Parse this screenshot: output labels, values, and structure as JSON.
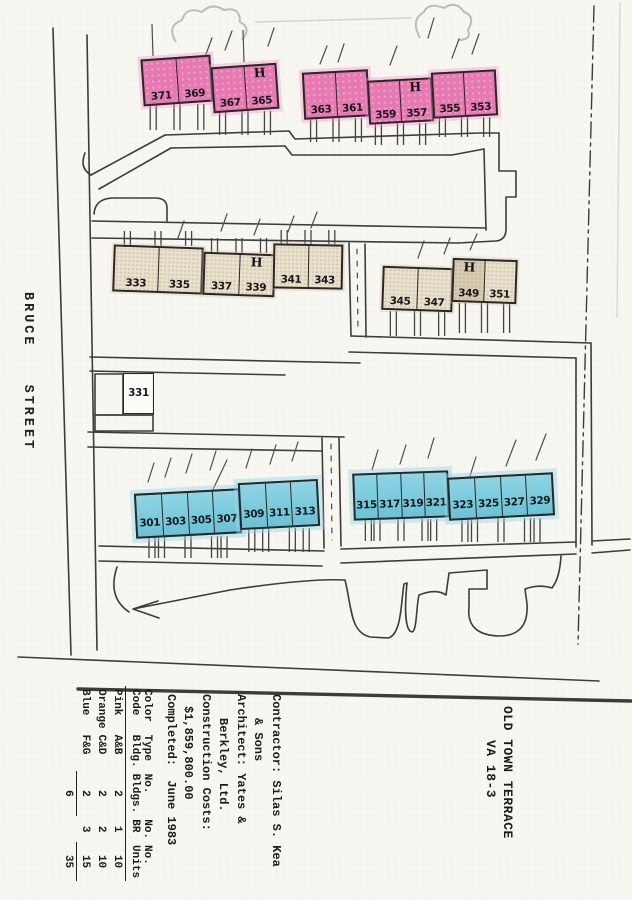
{
  "street_label": "BRUCE STREET",
  "title_block": {
    "project_title_line1": "OLD TOWN TERRACE",
    "project_title_line2": "VA 18-3",
    "info_lines": [
      "Contractor: Silas S. Kea",
      "& Sons",
      "Architect: Yates &",
      "Berkley, Ltd.",
      "Construction Costs:",
      "$1,859,800.00",
      "Completed:  June 1983"
    ]
  },
  "legend_table": {
    "headers": [
      "Color Code",
      "Type Bldg.",
      "No. Bldgs.",
      "No. BR",
      "No. Units"
    ],
    "rows": [
      [
        "Pink",
        "A&B",
        "2",
        "1",
        "10"
      ],
      [
        "Orange",
        "C&D",
        "2",
        "2",
        "10"
      ],
      [
        "Blue",
        "F&G",
        "2",
        "3",
        "15"
      ]
    ],
    "totals": {
      "bldgs": "6",
      "units": "35"
    }
  },
  "colors": {
    "pink": "#e678b2",
    "orange_tan": "#e9e1cd",
    "blue": "#72cade"
  },
  "map": {
    "handicap_marker": "H",
    "buildings": [
      {
        "x": 142,
        "y": 57,
        "w": 70,
        "h": 47,
        "rot": -4,
        "color": "pink",
        "units": [
          {
            "n": "371"
          },
          {
            "n": "369"
          }
        ],
        "stub": {
          "dir": "down",
          "len": 26
        }
      },
      {
        "x": 212,
        "y": 65,
        "w": 66,
        "h": 46,
        "rot": -4,
        "color": "pink",
        "units": [
          {
            "n": "367"
          },
          {
            "n": "365",
            "h": true
          }
        ],
        "stub": {
          "dir": "down",
          "len": 24
        }
      },
      {
        "x": 303,
        "y": 71,
        "w": 66,
        "h": 47,
        "rot": -3,
        "color": "pink",
        "units": [
          {
            "n": "363"
          },
          {
            "n": "361"
          }
        ],
        "stub": {
          "dir": "down",
          "len": 24
        }
      },
      {
        "x": 368,
        "y": 79,
        "w": 65,
        "h": 44,
        "rot": -3,
        "color": "pink",
        "units": [
          {
            "n": "359"
          },
          {
            "n": "357",
            "h": true
          }
        ],
        "stub": {
          "dir": "down",
          "len": 22
        }
      },
      {
        "x": 432,
        "y": 71,
        "w": 65,
        "h": 46,
        "rot": -3,
        "color": "pink",
        "units": [
          {
            "n": "355"
          },
          {
            "n": "353"
          }
        ],
        "stub": {
          "dir": "down",
          "len": 20
        }
      },
      {
        "x": 113,
        "y": 246,
        "w": 90,
        "h": 47,
        "rot": 2,
        "color": "tan",
        "units": [
          {
            "n": "333"
          },
          {
            "n": "335"
          }
        ],
        "stub": {
          "dir": "up",
          "len": 15
        }
      },
      {
        "x": 203,
        "y": 253,
        "w": 72,
        "h": 43,
        "rot": 2,
        "color": "tan",
        "units": [
          {
            "n": "337"
          },
          {
            "n": "339",
            "h": true
          }
        ],
        "stub": {
          "dir": "up",
          "len": 15
        }
      },
      {
        "x": 273,
        "y": 244,
        "w": 70,
        "h": 45,
        "rot": 1,
        "color": "tan",
        "units": [
          {
            "n": "341"
          },
          {
            "n": "343"
          }
        ],
        "stub": {
          "dir": "up",
          "len": 14
        }
      },
      {
        "x": 382,
        "y": 267,
        "w": 71,
        "h": 44,
        "rot": 2,
        "color": "tan",
        "units": [
          {
            "n": "345"
          },
          {
            "n": "347"
          }
        ],
        "stub": {
          "dir": "down",
          "len": 25
        }
      },
      {
        "x": 452,
        "y": 259,
        "w": 65,
        "h": 44,
        "rot": 2,
        "color": "tan",
        "units": [
          {
            "n": "349",
            "h": true,
            "dark": true
          },
          {
            "n": "351"
          }
        ],
        "stub": {
          "dir": "down",
          "len": 30
        }
      },
      {
        "x": 123,
        "y": 373,
        "w": 31,
        "h": 41,
        "rot": 0,
        "color": "white",
        "units": [
          {
            "n": "331"
          }
        ]
      },
      {
        "x": 135,
        "y": 491,
        "w": 106,
        "h": 45,
        "rot": -3,
        "color": "blue",
        "units": [
          {
            "n": "301"
          },
          {
            "n": "303"
          },
          {
            "n": "305"
          },
          {
            "n": "307"
          }
        ],
        "stub": {
          "dir": "down",
          "len": 22
        }
      },
      {
        "x": 239,
        "y": 481,
        "w": 80,
        "h": 47,
        "rot": -3,
        "color": "blue",
        "units": [
          {
            "n": "309"
          },
          {
            "n": "311"
          },
          {
            "n": "313"
          }
        ],
        "stub": {
          "dir": "down",
          "len": 24
        }
      },
      {
        "x": 353,
        "y": 472,
        "w": 96,
        "h": 47,
        "rot": -2,
        "color": "blue",
        "units": [
          {
            "n": "315"
          },
          {
            "n": "317"
          },
          {
            "n": "319"
          },
          {
            "n": "321"
          }
        ],
        "stub": {
          "dir": "down",
          "len": 22
        }
      },
      {
        "x": 448,
        "y": 475,
        "w": 106,
        "h": 43,
        "rot": -3,
        "color": "blue",
        "units": [
          {
            "n": "323"
          },
          {
            "n": "325"
          },
          {
            "n": "327"
          },
          {
            "n": "329"
          }
        ],
        "stub": {
          "dir": "down",
          "len": 24
        }
      }
    ]
  }
}
